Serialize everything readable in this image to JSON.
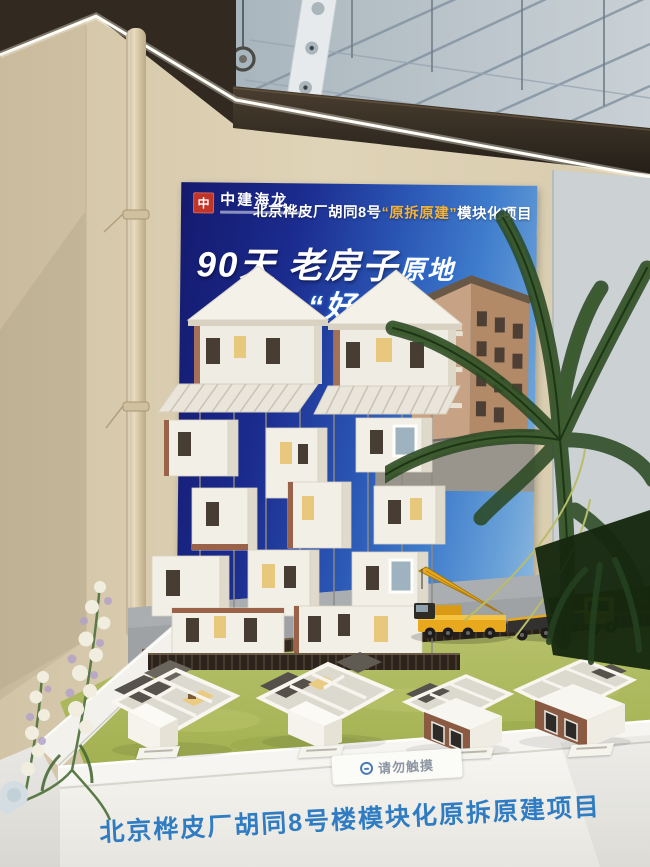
{
  "poster": {
    "logo": {
      "seal": "中",
      "name": "中建海龙"
    },
    "title": {
      "pre": "北京桦皮厂胡同8号",
      "highlight": "“原拆原建”",
      "post": "模块化项目"
    },
    "slogan": {
      "big": "90天",
      "mid": " 老房子",
      "tail": "原地",
      "line2_fragment": "“好房"
    }
  },
  "exhibit": {
    "notice_label": "请勿触摸",
    "banner": "北京桦皮厂胡同8号楼模块化原拆原建项目"
  },
  "colors": {
    "poster_navy": "#1b2b8e",
    "poster_highlight_gold": "#f2b23e",
    "banner_blue": "#2f7cc3",
    "crane_yellow": "#e9a91f",
    "grass_green": "#aeba62",
    "wall_beige": "#dccfb2"
  }
}
